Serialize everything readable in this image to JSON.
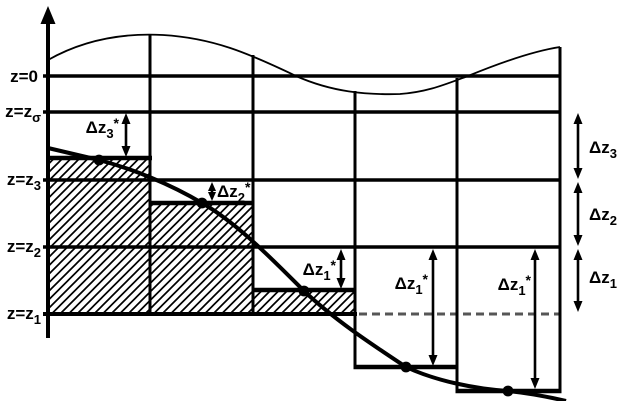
{
  "figure": {
    "colors": {
      "ink": "#000000",
      "background": "#ffffff",
      "dashed_level": "#565656"
    },
    "level_labels": [
      {
        "main": "z=0",
        "sub": ""
      },
      {
        "main": "z=z",
        "sub": "σ"
      },
      {
        "main": "z=z",
        "sub": "3"
      },
      {
        "main": "z=z",
        "sub": "2"
      },
      {
        "main": "z=z",
        "sub": "1"
      }
    ],
    "star_measure_labels": [
      {
        "main": "Δz",
        "sub": "3",
        "sup": "*"
      },
      {
        "main": "Δz",
        "sub": "2",
        "sup": "*"
      },
      {
        "main": "Δz",
        "sub": "1",
        "sup": "*"
      },
      {
        "main": "Δz",
        "sub": "1",
        "sup": "*"
      },
      {
        "main": "Δz",
        "sub": "1",
        "sup": "*"
      }
    ],
    "right_measure_labels": [
      {
        "main": "Δz",
        "sub": "3"
      },
      {
        "main": "Δz",
        "sub": "2"
      },
      {
        "main": "Δz",
        "sub": "1"
      }
    ]
  }
}
